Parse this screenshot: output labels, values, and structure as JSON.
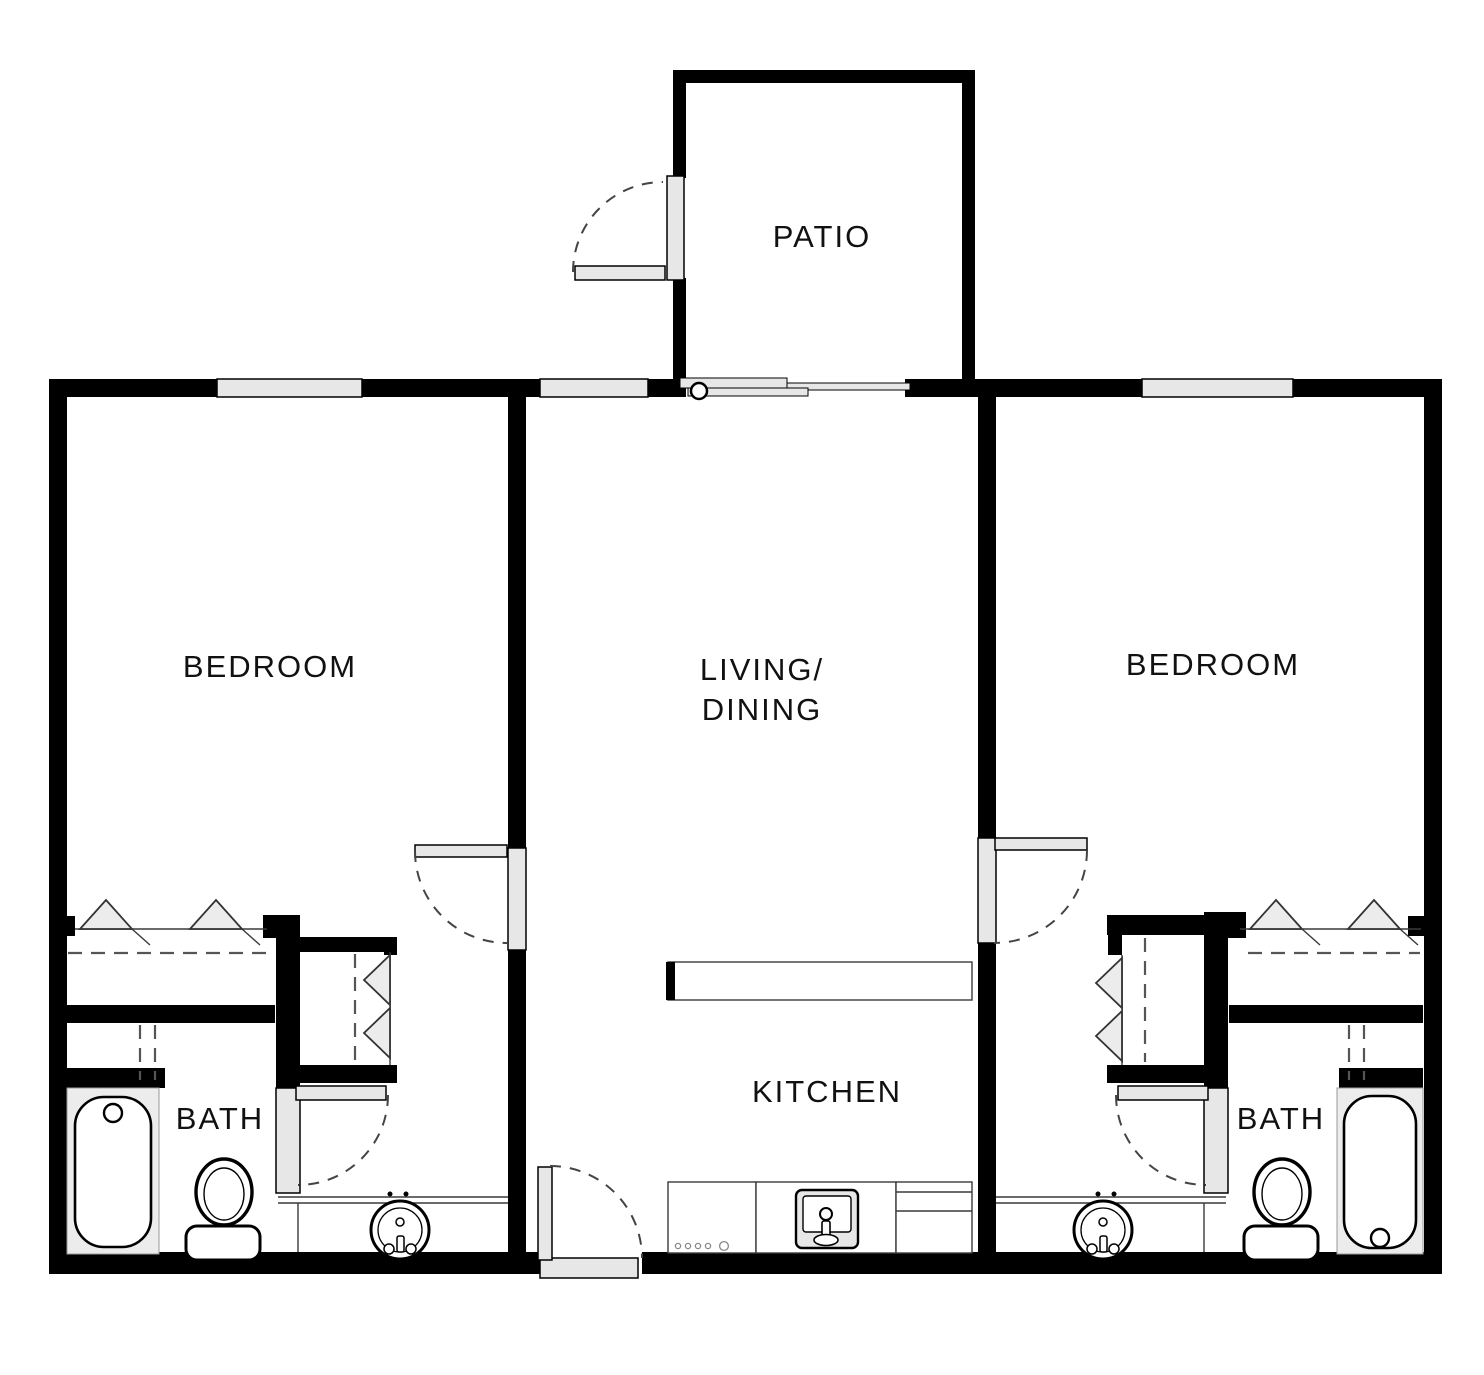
{
  "floor_plan": {
    "title": "Two bedroom apartment floor plan",
    "colors": {
      "background": "#ffffff",
      "walls": "#000000",
      "door_window_fill": "#e7e7e7",
      "dashed_lines": "#444444",
      "text": "#111111"
    },
    "rooms": {
      "patio": {
        "label": "PATIO"
      },
      "bedroom_left": {
        "label": "BEDROOM"
      },
      "living_dining": {
        "label_line1": "LIVING/",
        "label_line2": "DINING"
      },
      "bedroom_right": {
        "label": "BEDROOM"
      },
      "kitchen": {
        "label": "KITCHEN"
      },
      "bath_left": {
        "label": "BATH"
      },
      "bath_right": {
        "label": "BATH"
      }
    },
    "fixtures": [
      "bathtub-left",
      "toilet-left",
      "vanity-sink-left",
      "bathtub-right",
      "toilet-right",
      "vanity-sink-right",
      "kitchen-sink",
      "range",
      "breakfast-bar",
      "sliding-patio-door",
      "entry-door"
    ]
  }
}
